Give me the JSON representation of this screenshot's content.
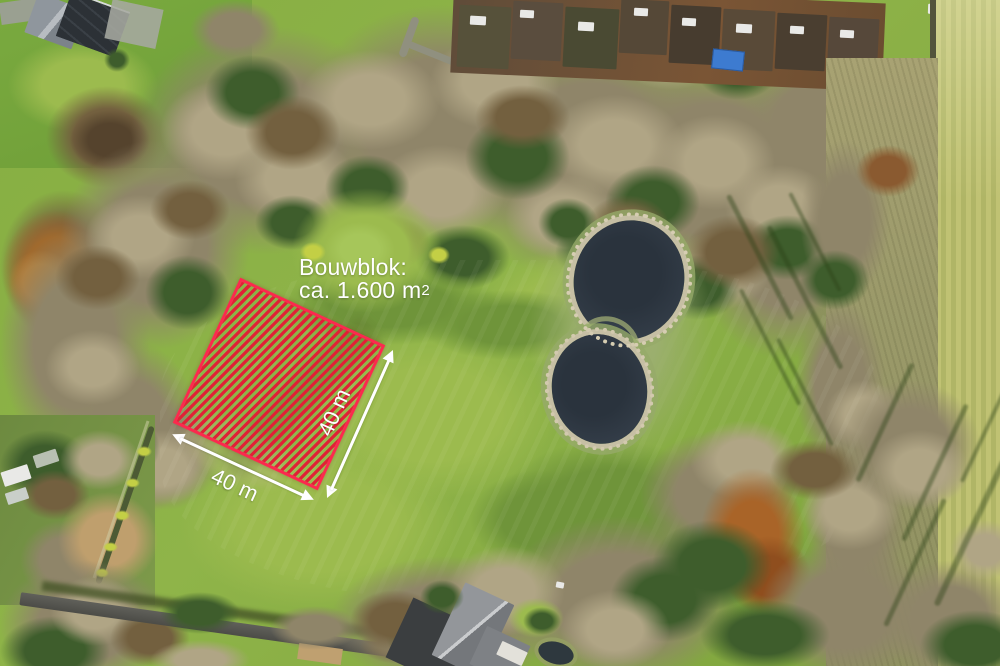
{
  "annotation": {
    "title": "Bouwblok:",
    "area_value": "ca. 1.600 m",
    "area_superscript": "2",
    "side_a_label": "40 m",
    "side_b_label": "40 m",
    "colors": {
      "hatch_stripe": "#e02136",
      "hatch_border": "#fb2a4e",
      "label_text": "#ffffff"
    }
  }
}
